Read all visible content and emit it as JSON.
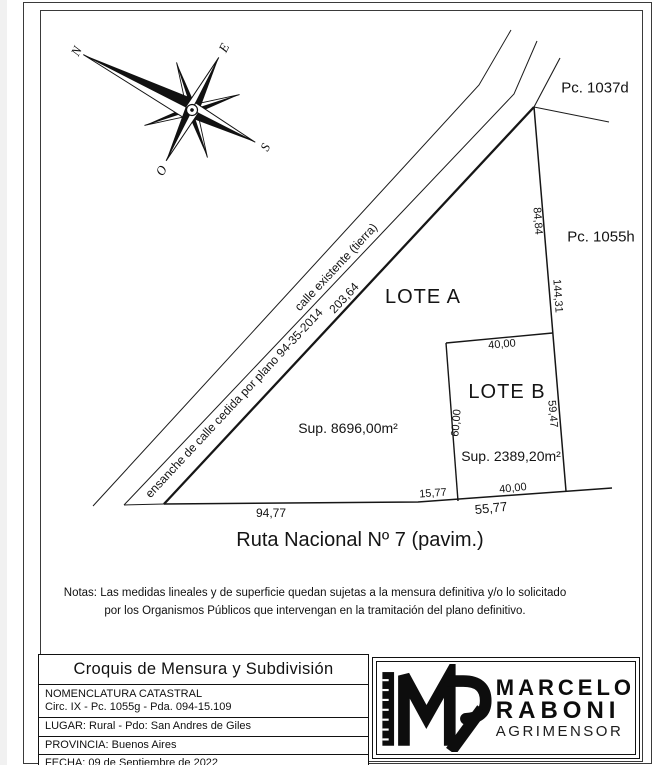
{
  "compass": {
    "north": "N",
    "east": "E",
    "south": "S",
    "west": "O"
  },
  "parcels": {
    "top": "Pc. 1037d",
    "right": "Pc. 1055h"
  },
  "lots": {
    "a": {
      "name": "LOTE A",
      "area": "Sup. 8696,00m²"
    },
    "b": {
      "name": "LOTE B",
      "area": "Sup. 2389,20m²"
    }
  },
  "roads": {
    "existing": "calle existente (tierra)",
    "widening": "ensanche de calle cedida por plano 94-35-2014",
    "route": "Ruta Nacional Nº 7 (pavim.)"
  },
  "measurements": {
    "nw_boundary": "203,64",
    "east_upper": "84,84",
    "east_total": "144,31",
    "lot_b_top": "40,00",
    "lot_b_left": "60,00",
    "lot_b_right": "59,47",
    "lot_b_bottom": "40,00",
    "front_left": "94,77",
    "front_gap": "15,77",
    "front_right_total": "55,77"
  },
  "notes": {
    "line1": "Notas: Las medidas lineales y de superficie quedan sujetas a la mensura definitiva y/o lo solicitado",
    "line2": "por los Organismos Públicos que intervengan en la tramitación del plano definitivo."
  },
  "title_block": {
    "title": "Croquis de Mensura y Subdivisión",
    "nomenclatura_label": "NOMENCLATURA CATASTRAL",
    "nomenclatura_value": "Circ. IX - Pc. 1055g - Pda. 094-15.109",
    "lugar": "LUGAR: Rural - Pdo: San Andres de Giles",
    "provincia": "PROVINCIA: Buenos Aires",
    "fecha": "FECHA: 09 de Septiembre de 2022"
  },
  "logo": {
    "first_name": "MARCELO",
    "last_name": "RABONI",
    "profession": "AGRIMENSOR"
  }
}
